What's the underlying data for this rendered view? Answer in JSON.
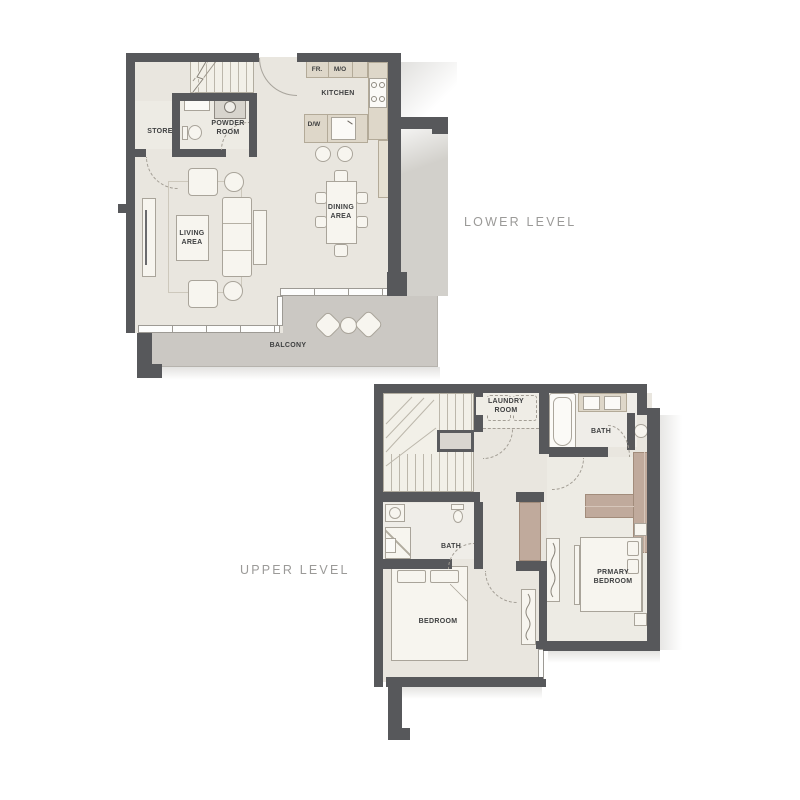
{
  "lower_level": {
    "title": "LOWER LEVEL",
    "rooms": {
      "store": "STORE",
      "powder_room": "POWDER ROOM",
      "kitchen": "KITCHEN",
      "dining_area": "DINING AREA",
      "living_area": "LIVING AREA",
      "balcony": "BALCONY"
    },
    "appliances": {
      "fridge": "FR.",
      "microwave_oven": "M/O",
      "dishwasher": "D/W"
    }
  },
  "upper_level": {
    "title": "UPPER LEVEL",
    "rooms": {
      "laundry_room": "LAUNDRY ROOM",
      "bath_upper": "BATH",
      "bath_lower": "BATH",
      "primary_bedroom": "PRMARY BEDROOM",
      "bedroom": "BEDROOM"
    }
  },
  "colors": {
    "wall": "#57585b",
    "floor": "#e9e6df",
    "counter": "#ded7c9",
    "balcony": "#cbc8c3",
    "wardrobe": "#c0aa9c",
    "room_label": "#3f4041",
    "level_label": "#9b9a98"
  }
}
